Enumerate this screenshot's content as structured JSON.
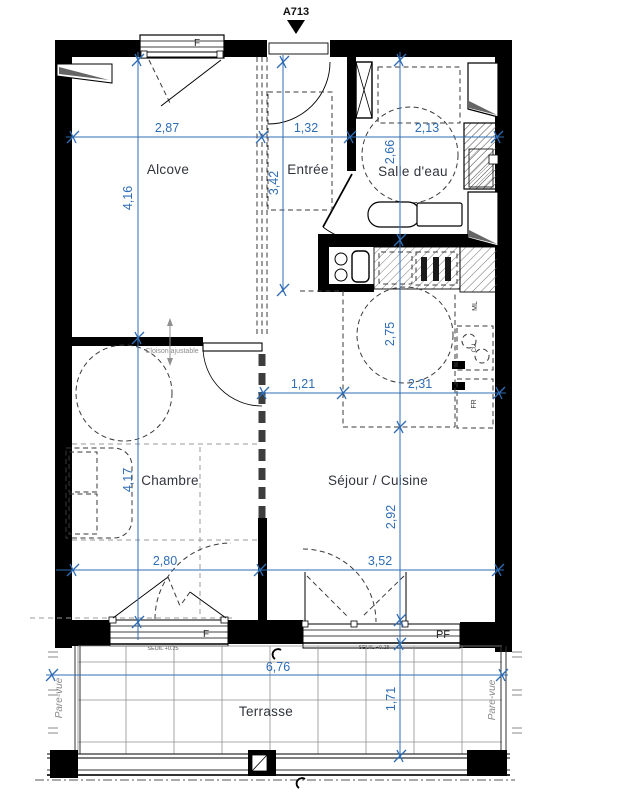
{
  "title": {
    "lot": "A713"
  },
  "rooms": {
    "alcove": "Alcove",
    "entree": "Entrée",
    "salle_deau": "Salle d'eau",
    "chambre": "Chambre",
    "sejour_cuisine": "Séjour / Cuisine",
    "terrasse": "Terrasse"
  },
  "dims": {
    "alcove_w": "2,87",
    "entree_w": "1,32",
    "salle_deau_w": "2,13",
    "alcove_h": "4,16",
    "chambre_h": "4,17",
    "entree_h": "3,42",
    "salle_deau_h": "2,66",
    "cuisine_h": "2,75",
    "sejour_h": "2,92",
    "passage_w": "1,21",
    "cuisine_w": "2,31",
    "chambre_w": "2,80",
    "sejour_w": "3,52",
    "terrasse_w": "6,76",
    "terrasse_d": "1,71"
  },
  "openings": {
    "window_alcove": "F",
    "window_chambre": "F",
    "window_sejour": "PF",
    "seuil_chambre": "SEUIL +0.25",
    "seuil_sejour": "SEUIL +0.25"
  },
  "annotations": {
    "cloison": "Cloison ajustable",
    "pare_vue_left": "Pare-vue",
    "pare_vue_right": "Pare-vue",
    "appliance_ml": "ML",
    "appliance_cu": "CU",
    "appliance_fr": "FR"
  },
  "colors": {
    "dimension_blue": "#2f6db5",
    "wall": "#000000",
    "room_label": "#30343c",
    "annotation_gray": "#8c8c8c"
  }
}
